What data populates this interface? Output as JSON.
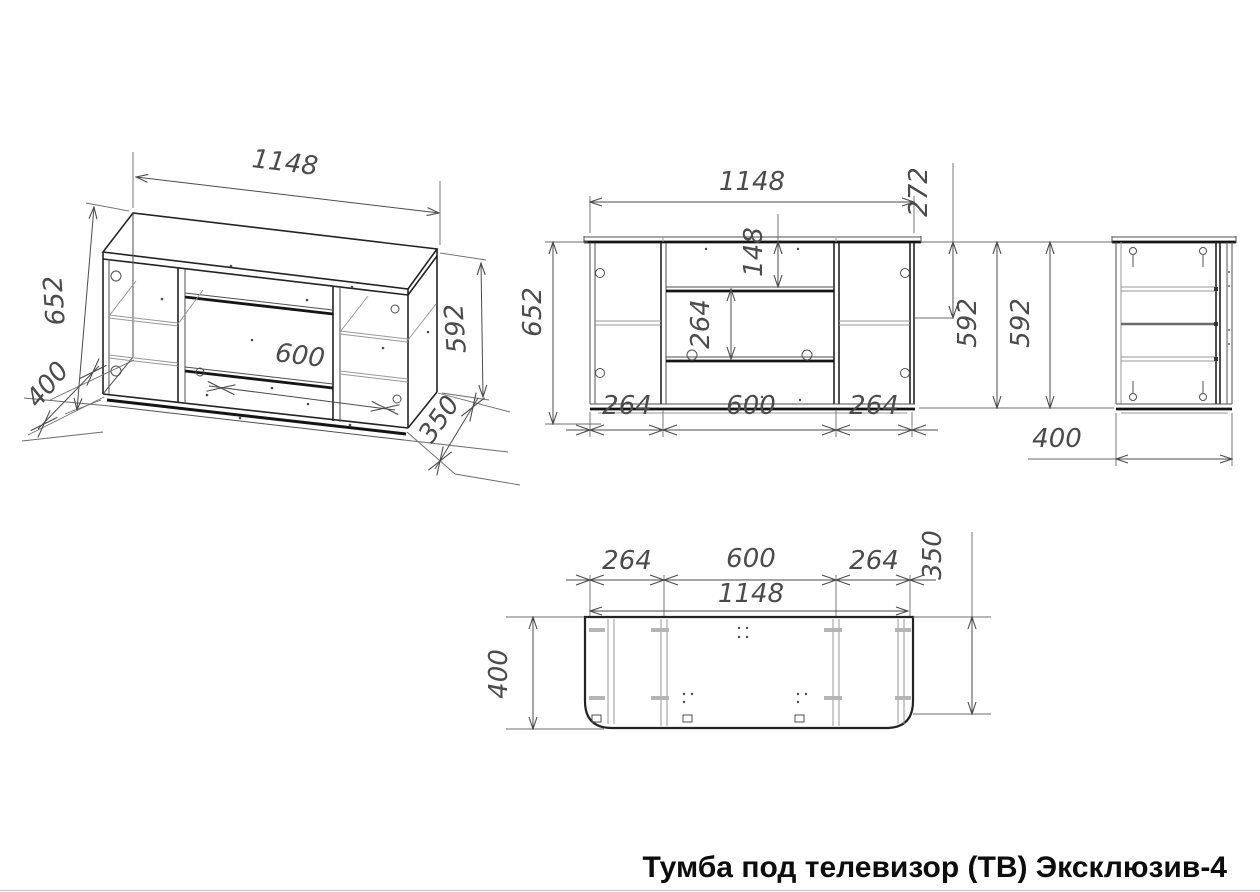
{
  "title": "Тумба под телевизор (ТВ) Эксклюзив-4",
  "colors": {
    "line_dark": "#141414",
    "line_mid": "#4f4f4f",
    "line_light": "#979797",
    "dim_text": "#4b4b4b",
    "background": "#ffffff"
  },
  "views": {
    "isometric": {
      "width": "1148",
      "height_overall": "652",
      "depth": "400",
      "side_height": "592",
      "depth_front": "350",
      "niche_width": "600"
    },
    "front": {
      "width": "1148",
      "top_to_side_shelf": "272",
      "top_to_niche_shelf": "148",
      "niche_opening_height": "264",
      "height_overall": "652",
      "side_height": "592",
      "left_section_width": "264",
      "niche_width": "600",
      "right_section_width": "264"
    },
    "side": {
      "height": "592",
      "depth": "400"
    },
    "plan": {
      "left_section_width": "264",
      "niche_width": "600",
      "right_section_width": "264",
      "width": "1148",
      "depth_front": "350",
      "depth": "400"
    }
  }
}
